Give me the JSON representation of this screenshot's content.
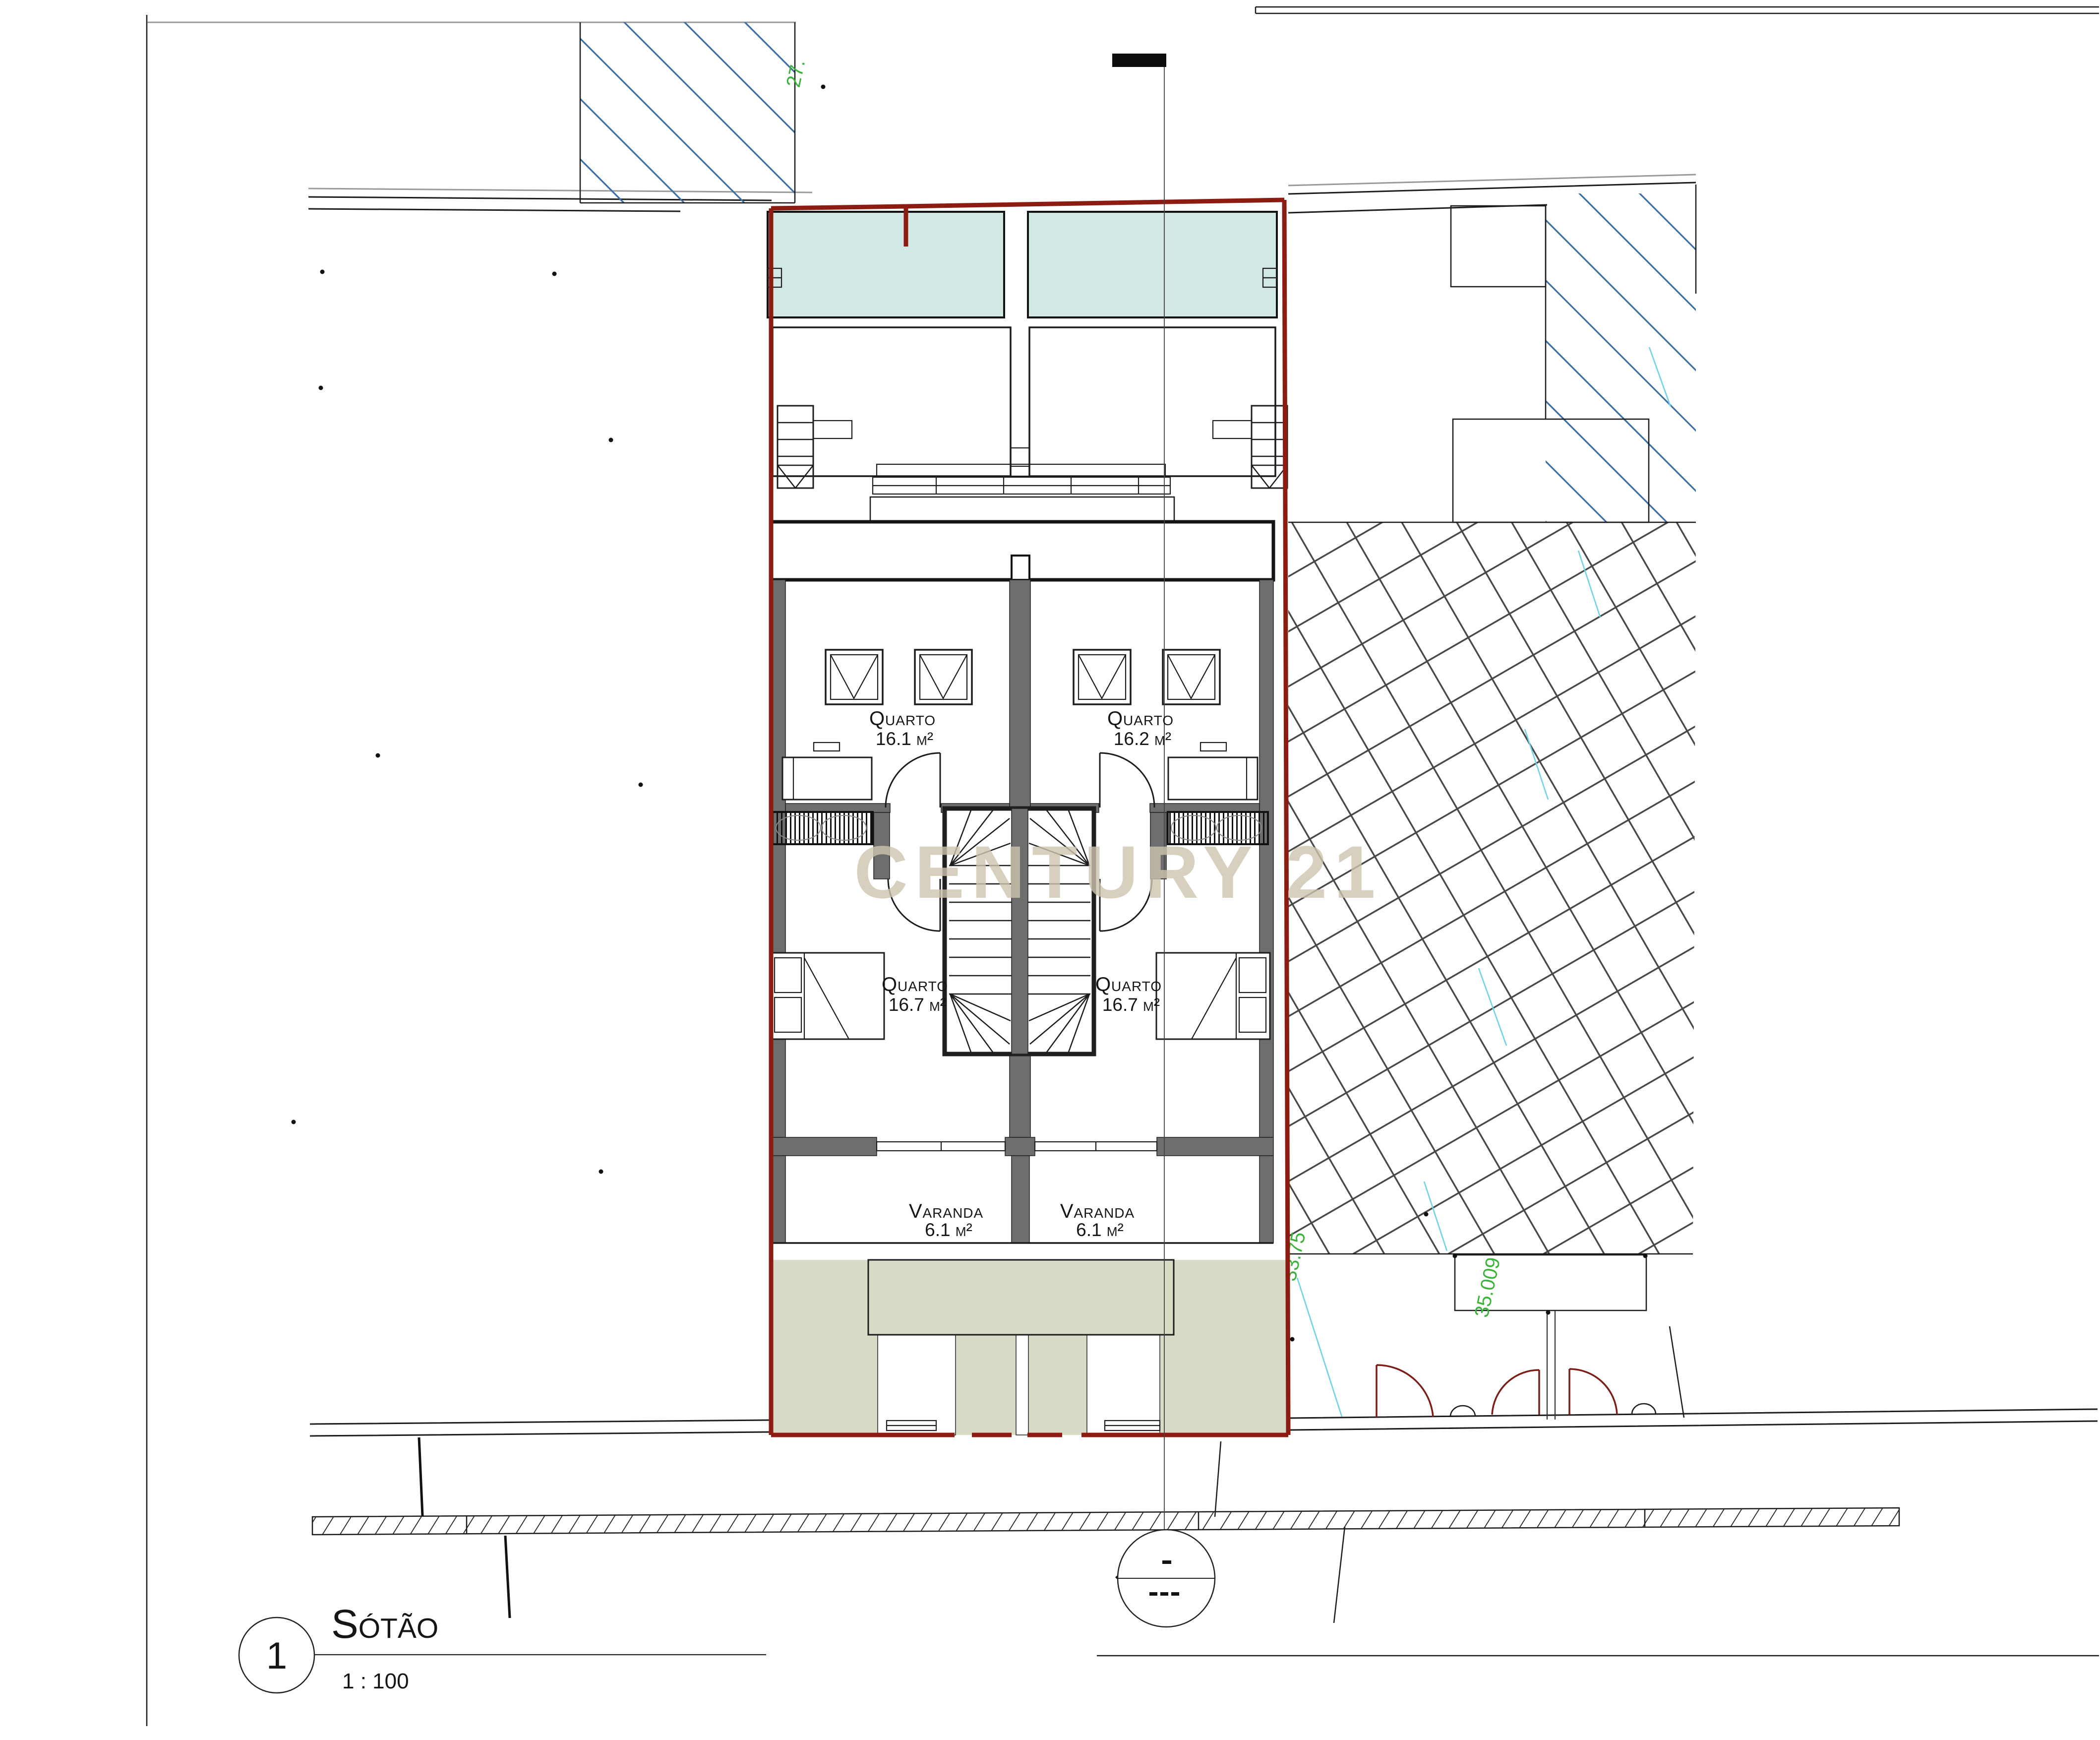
{
  "document": {
    "watermark": "CENTURY 21",
    "title_block": {
      "sheet_number": "1",
      "title": "Sótão",
      "scale": "1 : 100"
    }
  },
  "rooms": {
    "quarto_upper_left": {
      "name": "Quarto",
      "area": "16.1 m²"
    },
    "quarto_upper_right": {
      "name": "Quarto",
      "area": "16.2 m²"
    },
    "quarto_lower_left": {
      "name": "Quarto",
      "area": "16.7 m²"
    },
    "quarto_lower_right": {
      "name": "Quarto",
      "area": "16.7 m²"
    },
    "varanda_left": {
      "name": "Varanda",
      "area": "6.1 m²"
    },
    "varanda_right": {
      "name": "Varanda",
      "area": "6.1 m²"
    }
  },
  "survey": {
    "elevation_top": "27.",
    "elevation_mid": "33.75",
    "elevation_bottom": "35.009"
  },
  "colors": {
    "boundary_red": "#8c1b12",
    "glass_teal": "#d2e8e4",
    "lawn_green": "#d6dcc5",
    "wall_gray": "#6e6e6e",
    "watermark_beige": "#cfc5ae",
    "hatch_blue": "#3a6da3",
    "hatch_green": "#3bb33b",
    "survey_cyan": "#6fd3e8",
    "door_red": "#7c1d18"
  }
}
